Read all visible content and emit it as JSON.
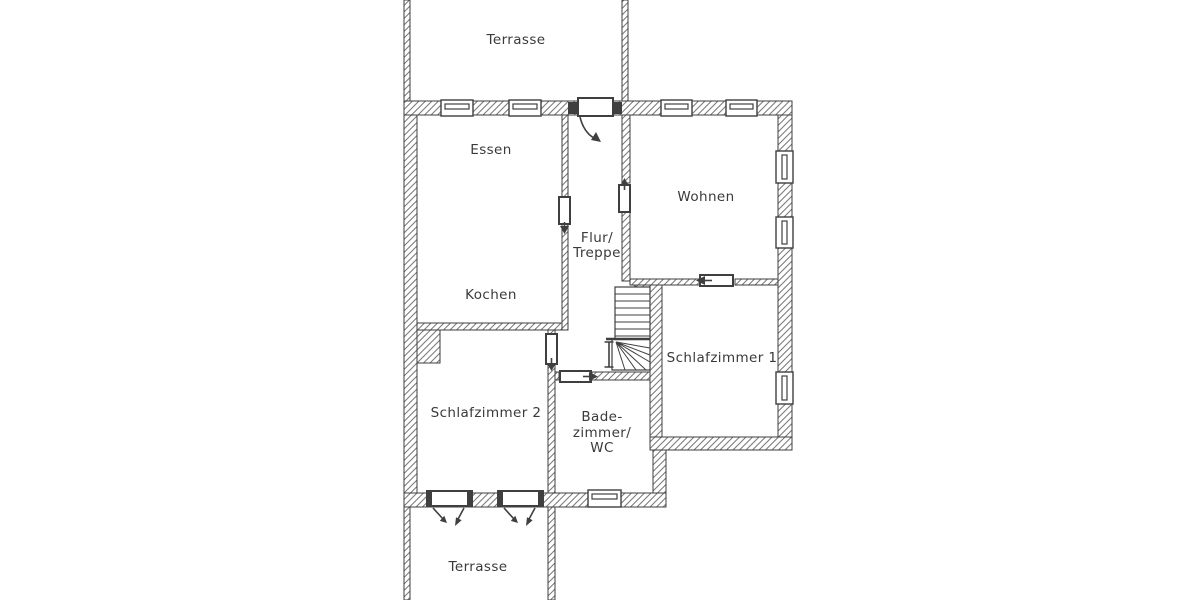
{
  "document": {
    "type": "floorplan",
    "language": "de"
  },
  "colors": {
    "line": "#3f3f3f",
    "hatch": "#7a7a7a",
    "text": "#3a3a3a",
    "bg": "#ffffff"
  },
  "floorplan": {
    "rooms": {
      "terrasse_top": "Terrasse",
      "essen": "Essen",
      "kochen": "Kochen",
      "flur_line1": "Flur/",
      "flur_line2": "Treppe",
      "wohnen": "Wohnen",
      "schlafzimmer1": "Schlafzimmer 1",
      "schlafzimmer2": "Schlafzimmer 2",
      "bad_line1": "Bade-",
      "bad_line2": "zimmer/",
      "bad_line3": "WC",
      "terrasse_bottom": "Terrasse"
    },
    "icons": [
      "window-symbol",
      "door-leaf-symbol",
      "door-swing-arrow",
      "staircase-symbol",
      "wall-hatching"
    ]
  }
}
